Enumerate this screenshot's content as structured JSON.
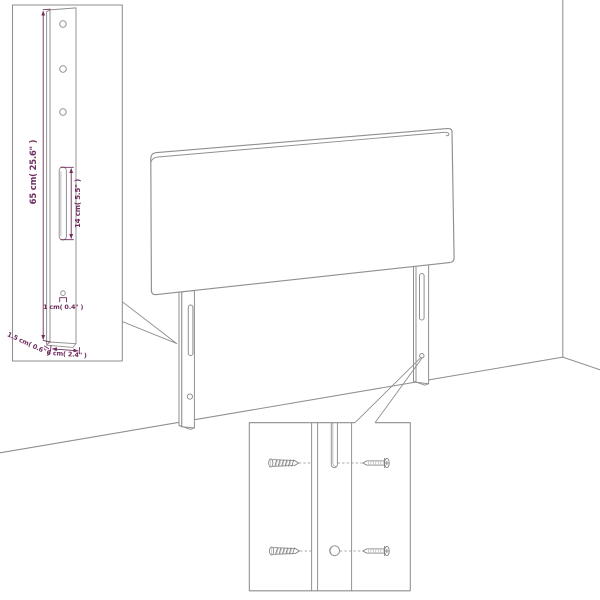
{
  "diagram_labels": {
    "leg_height": "65 cm( 25.6\" )",
    "slot_length": "14 cm( 5.5\" )",
    "hole_diameter": "1 cm( 0.4\" )",
    "leg_thickness": "1.5 cm( 0.6\" )",
    "leg_width": "6 cm( 2.4\" )"
  },
  "colors": {
    "outline": "#8f8f8f",
    "dimension": "#6f2c5e",
    "background": "#ffffff"
  }
}
